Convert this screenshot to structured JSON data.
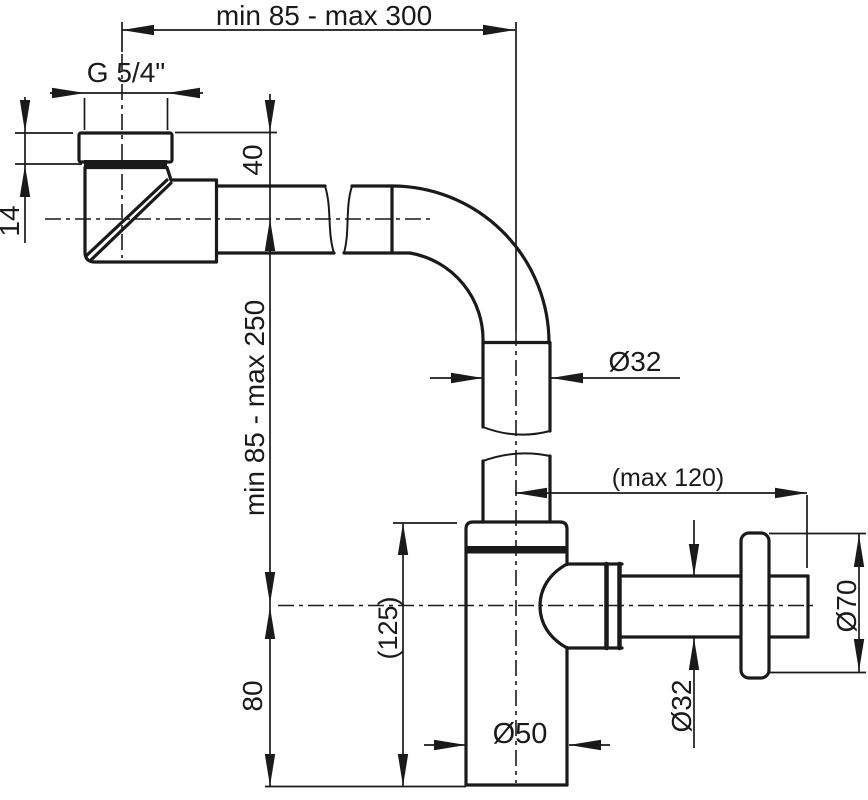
{
  "drawing": {
    "type": "technical-drawing",
    "subject": "bottle trap siphon with wall outlet, side view with dimensions",
    "colors": {
      "line": "#1a1a1a",
      "background": "#ffffff"
    },
    "dimensions": {
      "top_span": "min 85 - max 300",
      "thread": "G 5/4\"",
      "nut_height": "14",
      "inlet_drop": "40",
      "vertical_span": "min 85 - max 250",
      "pipe_diameter": "Ø32",
      "outlet_reach": "(max 120)",
      "flange_diameter": "Ø70",
      "body_height": "(125)",
      "outlet_height": "80",
      "outlet_diameter": "Ø32",
      "cup_diameter": "Ø50"
    }
  }
}
